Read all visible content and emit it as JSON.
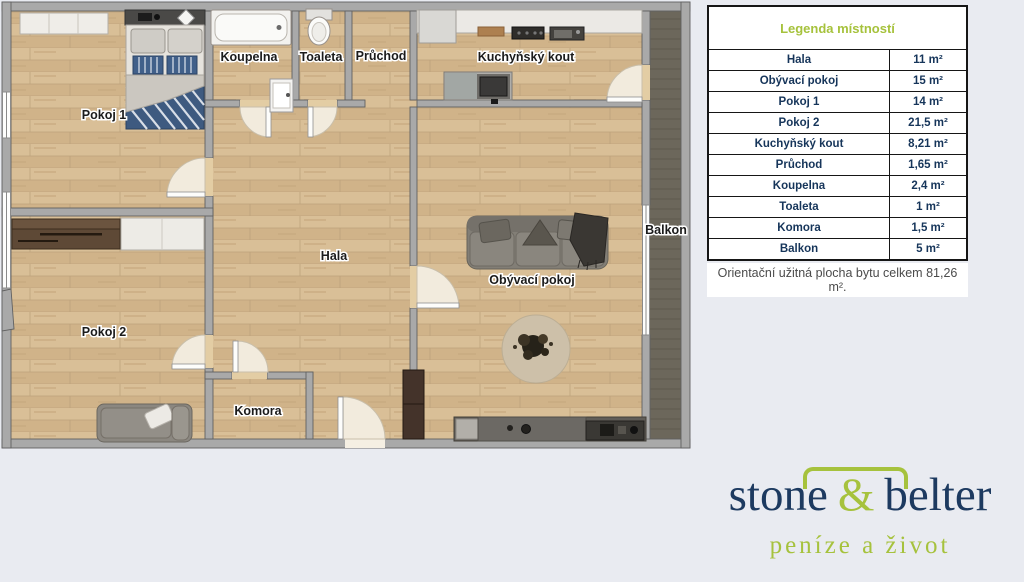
{
  "floorplan": {
    "rooms": {
      "pokoj1": "Pokoj 1",
      "koupelna": "Koupelna",
      "toaleta": "Toaleta",
      "pruchod": "Průchod",
      "kuchynsky_kout": "Kuchyňský kout",
      "hala": "Hala",
      "obyvaci_pokoj": "Obývací pokoj",
      "pokoj2": "Pokoj 2",
      "komora": "Komora",
      "balkon": "Balkon"
    }
  },
  "legend": {
    "title": "Legenda místností",
    "rows": [
      {
        "name": "Hala",
        "area": "11 m²"
      },
      {
        "name": "Obývací pokoj",
        "area": "15 m²"
      },
      {
        "name": "Pokoj 1",
        "area": "14 m²"
      },
      {
        "name": "Pokoj 2",
        "area": "21,5 m²"
      },
      {
        "name": "Kuchyňský kout",
        "area": "8,21 m²"
      },
      {
        "name": "Průchod",
        "area": "1,65 m²"
      },
      {
        "name": "Koupelna",
        "area": "2,4 m²"
      },
      {
        "name": "Toaleta",
        "area": "1 m²"
      },
      {
        "name": "Komora",
        "area": "1,5 m²"
      },
      {
        "name": "Balkon",
        "area": "5 m²"
      }
    ],
    "footer": "Orientační užitná plocha bytu celkem 81,26 m²."
  },
  "logo": {
    "word1": "stone",
    "amp": "&",
    "word2": "belter",
    "tagline": "peníze a život"
  },
  "colors": {
    "accent_green": "#a6c23d",
    "brand_navy": "#1d3a60",
    "wall_gray": "#a9a9a9",
    "floor_wood": "#d5b98f",
    "balcony_floor": "#6c675b",
    "page_background": "#e9ebf1"
  }
}
